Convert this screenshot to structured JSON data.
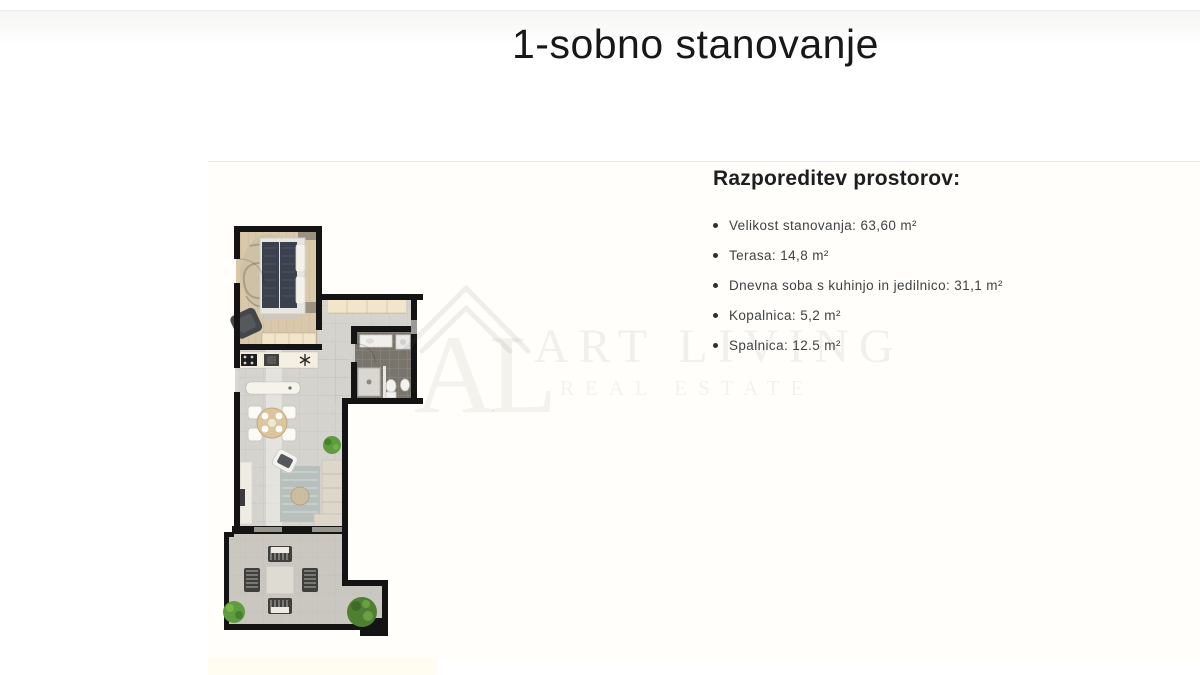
{
  "page": {
    "title": "1-sobno stanovanje"
  },
  "image_panel": {
    "heading": "Razporeditev prostorov:",
    "items": [
      "Velikost stanovanja: 63,60 m²",
      "Terasa: 14,8 m²",
      "Dnevna soba s kuhinjo in jedilnico: 31,1 m²",
      "Kopalnica: 5,2 m²",
      "Spalnica: 12.5 m²"
    ],
    "watermark": {
      "monogram": "AL",
      "name": "ART LIVING",
      "tagline": "REAL ESTATE"
    }
  },
  "floor_plan": {
    "colors": {
      "wall": "#141414",
      "wood_floor": "#d9c8aa",
      "tile_floor": "#d4d3ce",
      "terrace_floor": "#c9c7c0",
      "bathroom_floor": "#7a756c",
      "closet_cream": "#f3e5c9",
      "bed_dark": "#3b414d",
      "plant_green": "#5f9c40"
    }
  }
}
